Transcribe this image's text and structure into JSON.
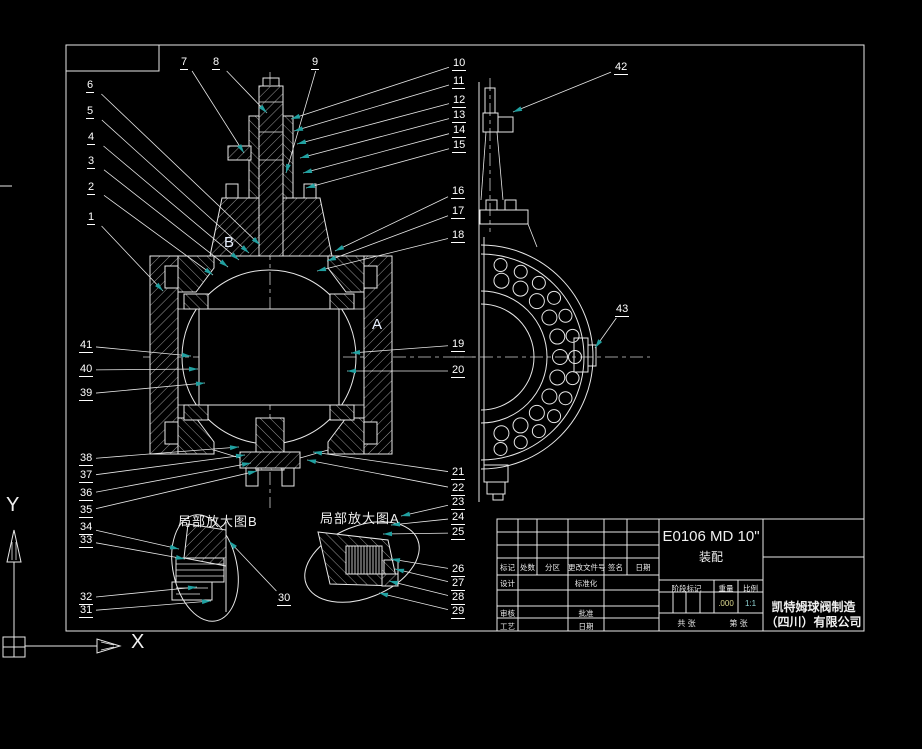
{
  "colors": {
    "background": "#000000",
    "line": "#e8e8e8",
    "leader_arrow": "#20a0a0",
    "weight_value_color": "#ddd98f",
    "scale_value_color": "#8fd3d3"
  },
  "axis_indicator": {
    "x_label": "X",
    "y_label": "Y"
  },
  "view_labels": {
    "section_b": "B",
    "section_a": "A",
    "detail_b": "局部放大图B",
    "detail_a": "局部放大图A"
  },
  "title_block": {
    "drawing_number": "E0106 MD 10\"",
    "drawing_title": "装配",
    "company_line1": "凯特姆球阀制造",
    "company_line2": "（四川）有限公司",
    "revision_headers": [
      "标记",
      "处数",
      "分区",
      "更改文件号",
      "签名",
      "日期"
    ],
    "left_labels": {
      "design": "设计",
      "check": "审核",
      "process": "工艺"
    },
    "mid_labels": {
      "standardization": "标准化",
      "approve": "批准",
      "date": "日期"
    },
    "stage_headers": [
      "阶段标记",
      "重量",
      "比例"
    ],
    "weight_value": ".000",
    "scale_value": "1:1",
    "sheet_total": "共  张",
    "sheet_number": "第  张"
  },
  "callouts": [
    {
      "n": "1",
      "x": 87,
      "y": 212,
      "tx": 163,
      "ty": 291
    },
    {
      "n": "2",
      "x": 87,
      "y": 182,
      "tx": 213,
      "ty": 275
    },
    {
      "n": "3",
      "x": 87,
      "y": 156,
      "tx": 228,
      "ty": 267
    },
    {
      "n": "4",
      "x": 87,
      "y": 132,
      "tx": 239,
      "ty": 260
    },
    {
      "n": "5",
      "x": 86,
      "y": 106,
      "tx": 249,
      "ty": 253
    },
    {
      "n": "6",
      "x": 86,
      "y": 80,
      "tx": 260,
      "ty": 245
    },
    {
      "n": "7",
      "x": 180,
      "y": 57,
      "tx": 244,
      "ty": 153
    },
    {
      "n": "8",
      "x": 212,
      "y": 57,
      "tx": 267,
      "ty": 113
    },
    {
      "n": "9",
      "x": 311,
      "y": 57,
      "tx": 286,
      "ty": 173
    },
    {
      "n": "10",
      "x": 452,
      "y": 58,
      "tx": 291,
      "ty": 119
    },
    {
      "n": "11",
      "x": 452,
      "y": 76,
      "tx": 294,
      "ty": 131
    },
    {
      "n": "12",
      "x": 452,
      "y": 95,
      "tx": 297,
      "ty": 144
    },
    {
      "n": "13",
      "x": 452,
      "y": 110,
      "tx": 300,
      "ty": 158
    },
    {
      "n": "14",
      "x": 452,
      "y": 125,
      "tx": 303,
      "ty": 173
    },
    {
      "n": "15",
      "x": 452,
      "y": 140,
      "tx": 306,
      "ty": 188
    },
    {
      "n": "16",
      "x": 451,
      "y": 186,
      "tx": 335,
      "ty": 251
    },
    {
      "n": "17",
      "x": 451,
      "y": 206,
      "tx": 327,
      "ty": 261
    },
    {
      "n": "18",
      "x": 451,
      "y": 230,
      "tx": 317,
      "ty": 271
    },
    {
      "n": "19",
      "x": 451,
      "y": 339,
      "tx": 351,
      "ty": 353
    },
    {
      "n": "20",
      "x": 451,
      "y": 365,
      "tx": 347,
      "ty": 371
    },
    {
      "n": "21",
      "x": 451,
      "y": 467,
      "tx": 313,
      "ty": 452
    },
    {
      "n": "22",
      "x": 451,
      "y": 483,
      "tx": 307,
      "ty": 460
    },
    {
      "n": "23",
      "x": 451,
      "y": 497,
      "tx": 401,
      "ty": 516
    },
    {
      "n": "24",
      "x": 451,
      "y": 512,
      "tx": 391,
      "ty": 525
    },
    {
      "n": "25",
      "x": 451,
      "y": 527,
      "tx": 383,
      "ty": 534
    },
    {
      "n": "26",
      "x": 451,
      "y": 564,
      "tx": 391,
      "ty": 559
    },
    {
      "n": "27",
      "x": 451,
      "y": 578,
      "tx": 395,
      "ty": 569
    },
    {
      "n": "28",
      "x": 451,
      "y": 592,
      "tx": 389,
      "ty": 581
    },
    {
      "n": "29",
      "x": 451,
      "y": 606,
      "tx": 379,
      "ty": 593
    },
    {
      "n": "30",
      "x": 277,
      "y": 593,
      "tx": 229,
      "ty": 541
    },
    {
      "n": "31",
      "x": 79,
      "y": 605,
      "tx": 211,
      "ty": 601
    },
    {
      "n": "32",
      "x": 79,
      "y": 592,
      "tx": 197,
      "ty": 587
    },
    {
      "n": "33",
      "x": 79,
      "y": 535,
      "tx": 185,
      "ty": 559
    },
    {
      "n": "34",
      "x": 79,
      "y": 522,
      "tx": 179,
      "ty": 549
    },
    {
      "n": "35",
      "x": 79,
      "y": 505,
      "tx": 257,
      "ty": 471
    },
    {
      "n": "36",
      "x": 79,
      "y": 488,
      "tx": 251,
      "ty": 463
    },
    {
      "n": "37",
      "x": 79,
      "y": 470,
      "tx": 245,
      "ty": 455
    },
    {
      "n": "38",
      "x": 79,
      "y": 453,
      "tx": 239,
      "ty": 447
    },
    {
      "n": "39",
      "x": 79,
      "y": 388,
      "tx": 205,
      "ty": 383
    },
    {
      "n": "40",
      "x": 79,
      "y": 364,
      "tx": 198,
      "ty": 369
    },
    {
      "n": "41",
      "x": 79,
      "y": 340,
      "tx": 191,
      "ty": 356
    },
    {
      "n": "42",
      "x": 614,
      "y": 62,
      "tx": 513,
      "ty": 112
    },
    {
      "n": "43",
      "x": 615,
      "y": 304,
      "tx": 595,
      "ty": 348
    }
  ]
}
